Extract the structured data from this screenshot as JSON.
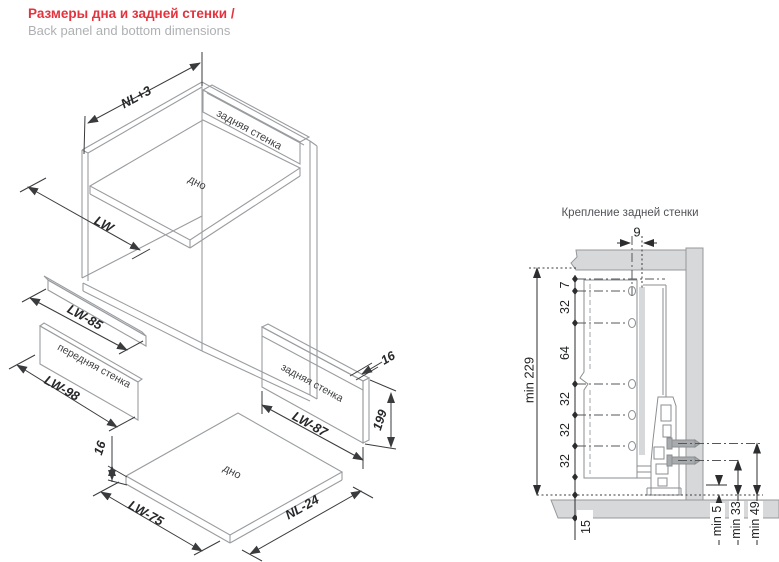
{
  "header": {
    "title_ru": "Размеры дна и задней стенки /",
    "title_en": "Back panel and bottom dimensions"
  },
  "exploded_view": {
    "labels": {
      "back_panel": "задняя стенка",
      "bottom": "дно",
      "front_panel": "передняя стенка",
      "back_panel_part": "задняя стенка",
      "bottom_part": "дно"
    },
    "dims": {
      "drawer_depth": "NL+3",
      "drawer_width": "LW",
      "rail_width": "LW-85",
      "front_panel_width": "LW-98",
      "back_panel_width": "LW-87",
      "back_panel_height": "199",
      "back_panel_thickness": "16",
      "bottom_width": "LW-75",
      "bottom_depth": "NL-24",
      "bottom_thickness": "16"
    }
  },
  "mounting_view": {
    "title": "Крепление задней стенки",
    "dims": {
      "hole_offset": "9",
      "chain": [
        "7",
        "32",
        "64",
        "32",
        "32",
        "32"
      ],
      "overall_height": "min 229",
      "floor_thickness": "15",
      "clearances": [
        "min 5",
        "min 33",
        "min 49"
      ]
    }
  },
  "colors": {
    "accent_red": "#e2333e",
    "subtitle_gray": "#aeb0b2",
    "cabinet_fill": "#d6d8d9",
    "outline_gray": "#9a9da0",
    "dim_dark": "#2c2d2f"
  }
}
